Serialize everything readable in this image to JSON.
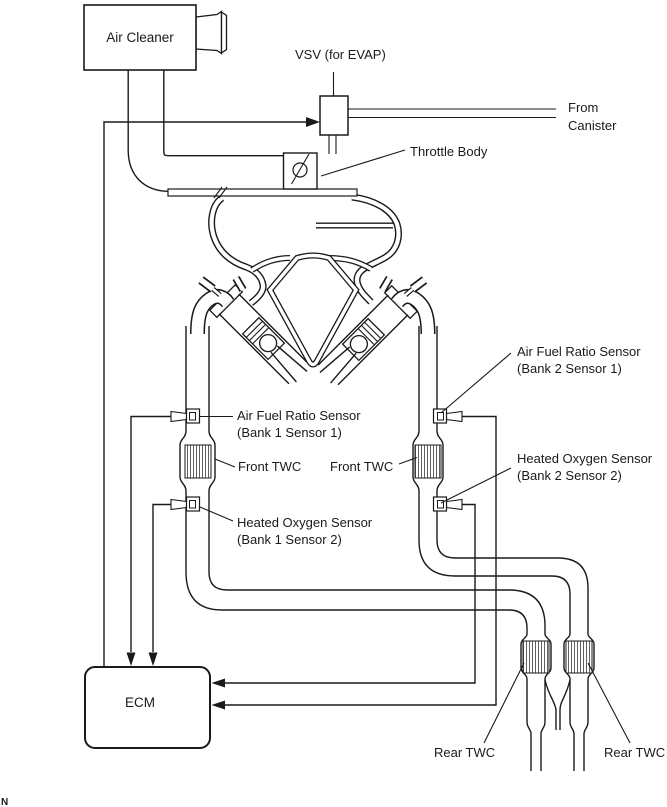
{
  "diagram": {
    "title_hint": "V6 engine emission control system schematic",
    "colors": {
      "line": "#1a1a1a",
      "background": "#ffffff"
    },
    "labels": {
      "air_cleaner": "Air Cleaner",
      "vsv": "VSV (for EVAP)",
      "from_canister_1": "From",
      "from_canister_2": "Canister",
      "throttle_body": "Throttle Body",
      "afr_b1_1": "Air Fuel Ratio Sensor",
      "afr_b1_2": "(Bank 1 Sensor 1)",
      "front_twc_left": "Front TWC",
      "front_twc_right": "Front TWC",
      "ho2s_b1_1": "Heated Oxygen Sensor",
      "ho2s_b1_2": "(Bank 1 Sensor 2)",
      "afr_b2_1": "Air Fuel Ratio Sensor",
      "afr_b2_2": "(Bank 2 Sensor 1)",
      "ho2s_b2_1": "Heated Oxygen Sensor",
      "ho2s_b2_2": "(Bank 2 Sensor 2)",
      "ecm": "ECM",
      "rear_twc_left": "Rear TWC",
      "rear_twc_right": "Rear TWC",
      "corner_mark": "N"
    }
  }
}
